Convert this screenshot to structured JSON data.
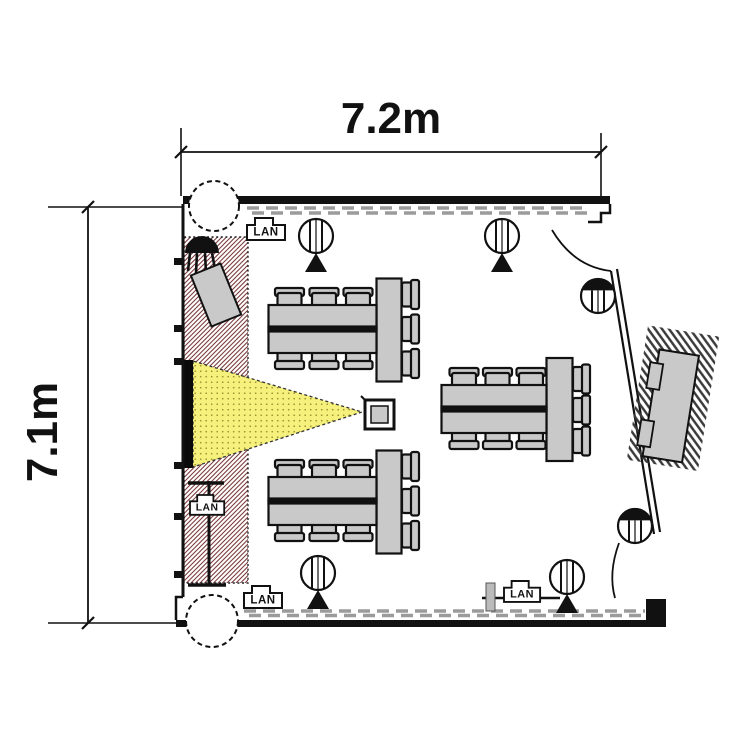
{
  "meta": {
    "type": "floor-plan",
    "background": "#ffffff"
  },
  "dimensions": {
    "width": "7.2m",
    "height": "7.1m"
  },
  "labels": {
    "lan": "LAN"
  },
  "colors": {
    "wall": "#111111",
    "furniture_gray": "#c9c9c9",
    "furniture_outline": "#111111",
    "beam_yellow": "#f6f17c",
    "beam_dot": "#9a922f",
    "hatch_red": "#7d3c3c",
    "hatch_dark": "#3a3a3a",
    "dash_gray": "#9b9b9b",
    "screen_black": "#0a0a0a"
  },
  "counts": {
    "table_groups": 3,
    "chairs_per_table": 9,
    "round_speakers": 4,
    "dome_speakers": 2,
    "columns": 2,
    "lan_outlets": 4,
    "doors": 2
  }
}
